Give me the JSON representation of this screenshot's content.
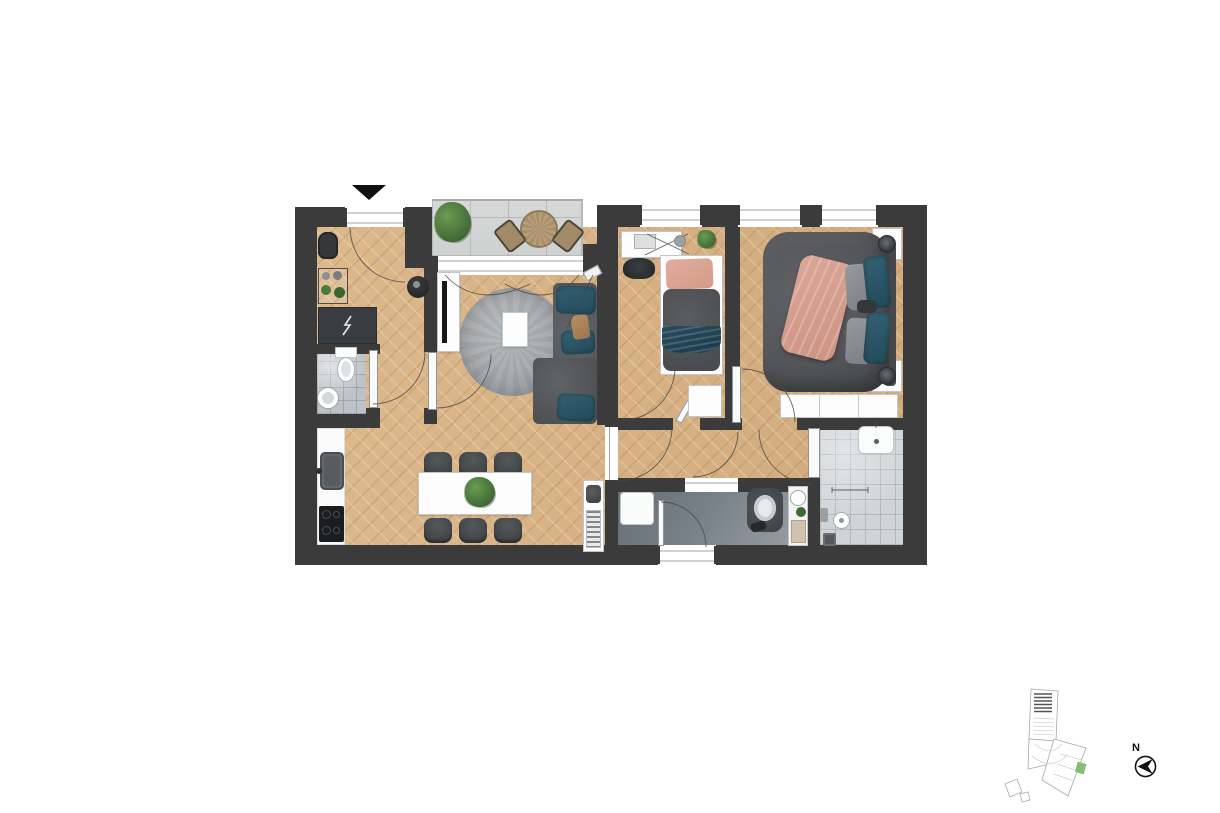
{
  "page": {
    "background": "#ffffff",
    "content": "apartment floor plan rendering, no visible text except north label"
  },
  "north_indicator": {
    "label": "N"
  },
  "palette": {
    "wall": "#3b3b3c",
    "wood_floor": "#d6b184",
    "balcony_tile": "#d4d6d5",
    "wc_tile": "#bcc2c7",
    "shower_tile": "#cfd4d8",
    "bathroom_floor": "#798188",
    "sofa_gray": "#56585b",
    "accent_teal": "#2b5061",
    "accent_pink": "#d8a192",
    "plant_green": "#4e7d3c",
    "site_plan_unit_green": "#86bd74"
  },
  "plan": {
    "entrance_marker": "black triangle pointing down at main entrance (top-left)",
    "rooms": [
      {
        "id": "entry-hall",
        "floor": "wood-herringbone"
      },
      {
        "id": "wc",
        "floor": "grey-tile"
      },
      {
        "id": "kitchen-dining",
        "floor": "wood-herringbone"
      },
      {
        "id": "living-room",
        "floor": "wood-herringbone"
      },
      {
        "id": "balcony",
        "floor": "large-grey-tile"
      },
      {
        "id": "hallway",
        "floor": "wood-herringbone"
      },
      {
        "id": "bedroom-small",
        "floor": "wood-herringbone"
      },
      {
        "id": "bedroom-master",
        "floor": "wood-herringbone"
      },
      {
        "id": "bathroom",
        "floor": "dark-grey"
      },
      {
        "id": "shower-room",
        "floor": "grey-tile"
      }
    ],
    "furniture": [
      "entry bench",
      "coat rack with plants",
      "dark storage cabinet",
      "round pouf",
      "wc toilet",
      "wc round washbasin",
      "balcony plant",
      "round balcony table with two chairs",
      "tv sideboard with tv",
      "round grey rug",
      "white coffee table",
      "corner sofa with teal cushions",
      "floor lamp",
      "kitchen counter",
      "kitchen sink",
      "cooktop with four burners",
      "dining table for six",
      "six dark chairs",
      "plant centerpiece",
      "utility cabinet with vent",
      "desk with laptop, lamp and plant",
      "stool",
      "single bed with pink pillow and teal throw",
      "small wardrobe",
      "double bed with pink blanket, teal and grey pillows",
      "two nightstands with round lamps",
      "large wardrobe",
      "washer",
      "toilet",
      "vanity with round basin and plant",
      "shower hand basin",
      "grab bar",
      "wall mixer",
      "round floor drain",
      "square floor drain"
    ],
    "doors": [
      "entrance door (top-left)",
      "wc door",
      "living room door",
      "hallway door",
      "small bedroom door (ajar)",
      "master bedroom door",
      "bathroom door",
      "shower room door",
      "bathroom exterior door",
      "balcony sliding door with curtains",
      "three bedroom windows"
    ]
  },
  "site_plan": {
    "description": "small building outline at bottom right with one unit highlighted",
    "highlight_color": "#86bd74"
  }
}
